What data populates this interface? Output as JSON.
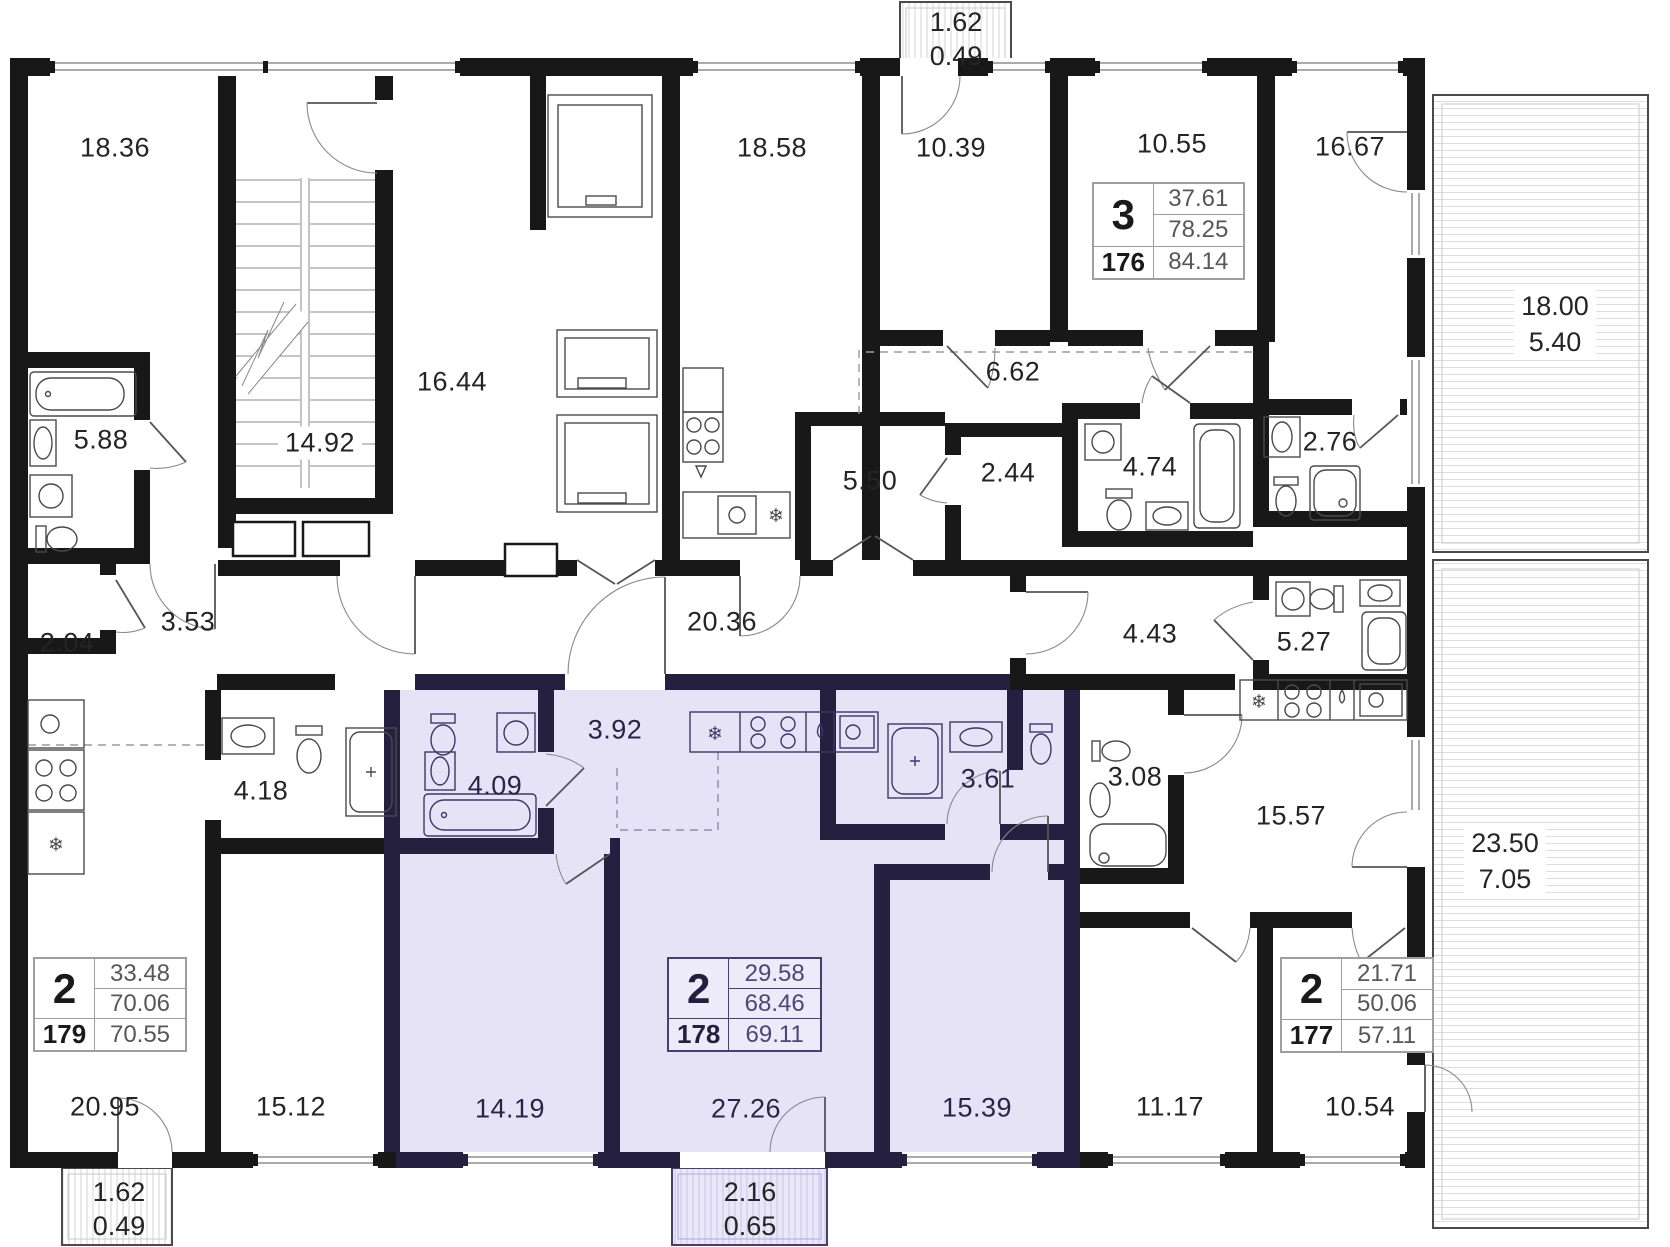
{
  "areas": {
    "a1836": "18.36",
    "a1492": "14.92",
    "a1644": "16.44",
    "a1858": "18.58",
    "a1039": "10.39",
    "a1055": "10.55",
    "a1667": "16.67",
    "a662": "6.62",
    "a550": "5.50",
    "a244": "2.44",
    "a474": "4.74",
    "a276": "2.76",
    "a588": "5.88",
    "a204": "2.04",
    "a353": "3.53",
    "a2036": "20.36",
    "a443": "4.43",
    "a527": "5.27",
    "a418": "4.18",
    "a409": "4.09",
    "a392": "3.92",
    "a361": "3.61",
    "a308": "3.08",
    "a1557": "15.57",
    "a2095": "20.95",
    "a1512": "15.12",
    "a1419": "14.19",
    "a2726": "27.26",
    "a1539": "15.39",
    "a1117": "11.17",
    "a1054": "10.54"
  },
  "balconies": {
    "top": {
      "a": "1.62",
      "b": "0.49"
    },
    "bottom_left": {
      "a": "1.62",
      "b": "0.49"
    },
    "bottom_center": {
      "a": "2.16",
      "b": "0.65"
    },
    "right_top": {
      "a": "18.00",
      "b": "5.40"
    },
    "right_bottom": {
      "a": "23.50",
      "b": "7.05"
    }
  },
  "apartments": {
    "apt176": {
      "rooms": "3",
      "area_living": "37.61",
      "area_base": "78.25",
      "number": "176",
      "area_total": "84.14"
    },
    "apt179": {
      "rooms": "2",
      "area_living": "33.48",
      "area_base": "70.06",
      "number": "179",
      "area_total": "70.55"
    },
    "apt178": {
      "rooms": "2",
      "area_living": "29.58",
      "area_base": "68.46",
      "number": "178",
      "area_total": "69.11"
    },
    "apt177": {
      "rooms": "2",
      "area_living": "21.71",
      "area_base": "50.06",
      "number": "177",
      "area_total": "57.11"
    }
  },
  "icons": {
    "fridge": "❄"
  },
  "colors": {
    "wall": "#181818",
    "wallp": "#251f40",
    "hl": "#e7e3f6",
    "hlb": "#eae7f8",
    "txt": "#242424",
    "txtp": "#2a2547"
  }
}
